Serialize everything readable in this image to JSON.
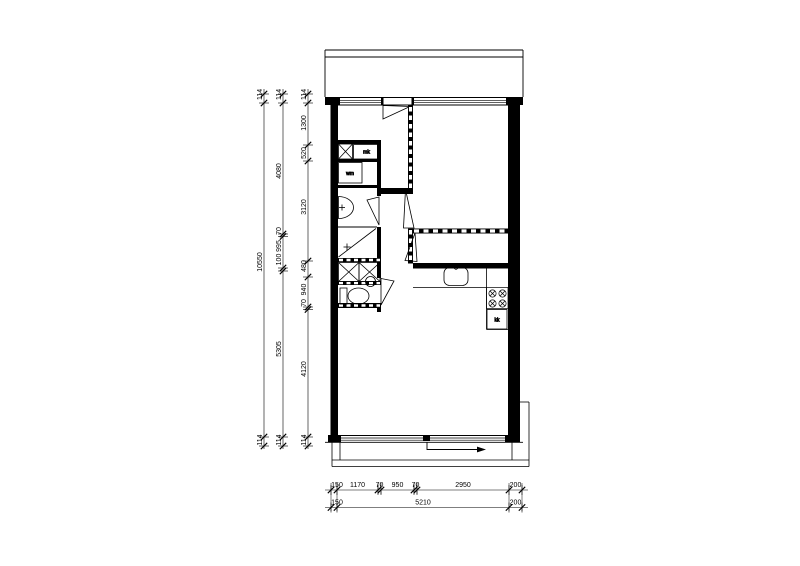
{
  "drawing": {
    "type": "apartment-floor-plan",
    "colors": {
      "ink": "#000000",
      "bg": "#ffffff"
    }
  },
  "fixtures": {
    "meter_cupboard": "mk",
    "washing_machine": "wm",
    "fridge": "kk"
  },
  "dims": {
    "left_outer": {
      "wall_top": "114",
      "total": "10550",
      "wall_bottom": "114"
    },
    "left_middle": {
      "wall_top": "114",
      "seg1": "4080",
      "seg2a": "70",
      "seg2b": "995",
      "seg2c": "100",
      "seg3": "5305",
      "wall_bottom": "114"
    },
    "left_inner": {
      "wall_top": "114",
      "seg1": "1300",
      "seg2": "520",
      "seg3": "3120",
      "seg4": "480",
      "seg5": "940",
      "seg6": "70",
      "seg7": "4120",
      "wall_bottom": "114"
    },
    "bottom_detail": [
      "150",
      "1170",
      "70",
      "950",
      "70",
      "2950",
      "200"
    ],
    "bottom_overall": [
      "150",
      "5210",
      "200"
    ]
  }
}
